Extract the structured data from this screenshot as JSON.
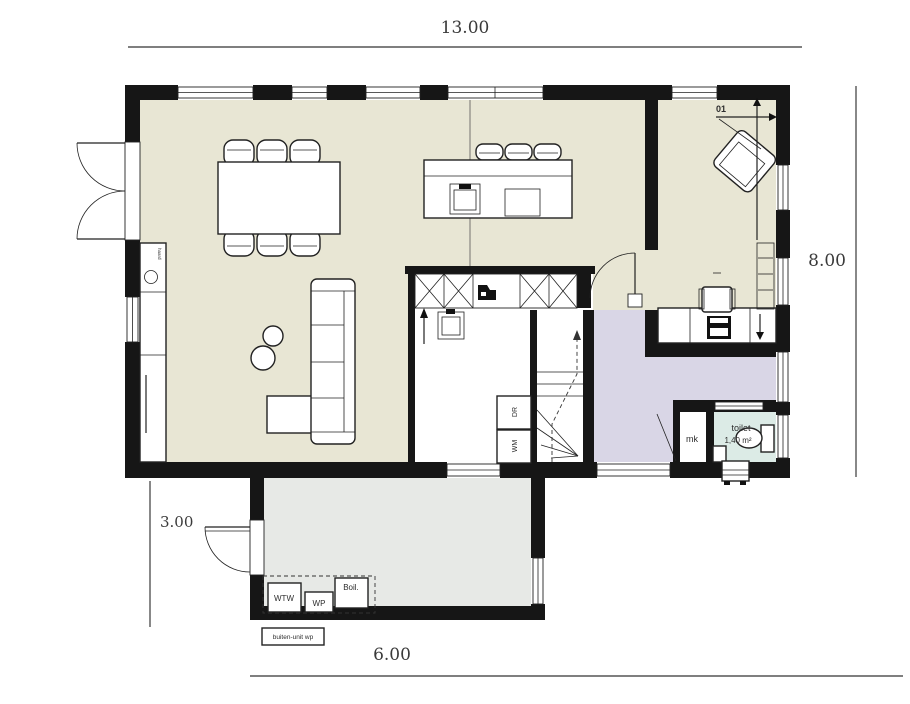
{
  "plan": {
    "dimensions": {
      "width_top": "13.00",
      "height_right": "8.00",
      "annex_height_left": "3.00",
      "annex_width_bottom": "6.00"
    },
    "rooms": {
      "living": {
        "fireplace_label": "haard"
      },
      "study": {
        "marker": "01"
      },
      "toilet": {
        "label": "toilet",
        "area": "1,40 m²"
      },
      "meter_cupboard": {
        "label": "mk"
      },
      "utility": {
        "dryer": "DR",
        "washer": "WM"
      },
      "garage": {
        "heat_recovery_unit": "WTW",
        "heat_pump": "WP",
        "boiler": "Boil.",
        "outdoor_unit": "buiten-unit wp"
      }
    },
    "colors": {
      "wall": "#161616",
      "floor_main": "#e8e6d4",
      "floor_hall": "#d9d6e6",
      "floor_toilet": "#dcebe6",
      "floor_garage": "#e7e9e6",
      "dimension_text": "#3a3a3a"
    }
  }
}
